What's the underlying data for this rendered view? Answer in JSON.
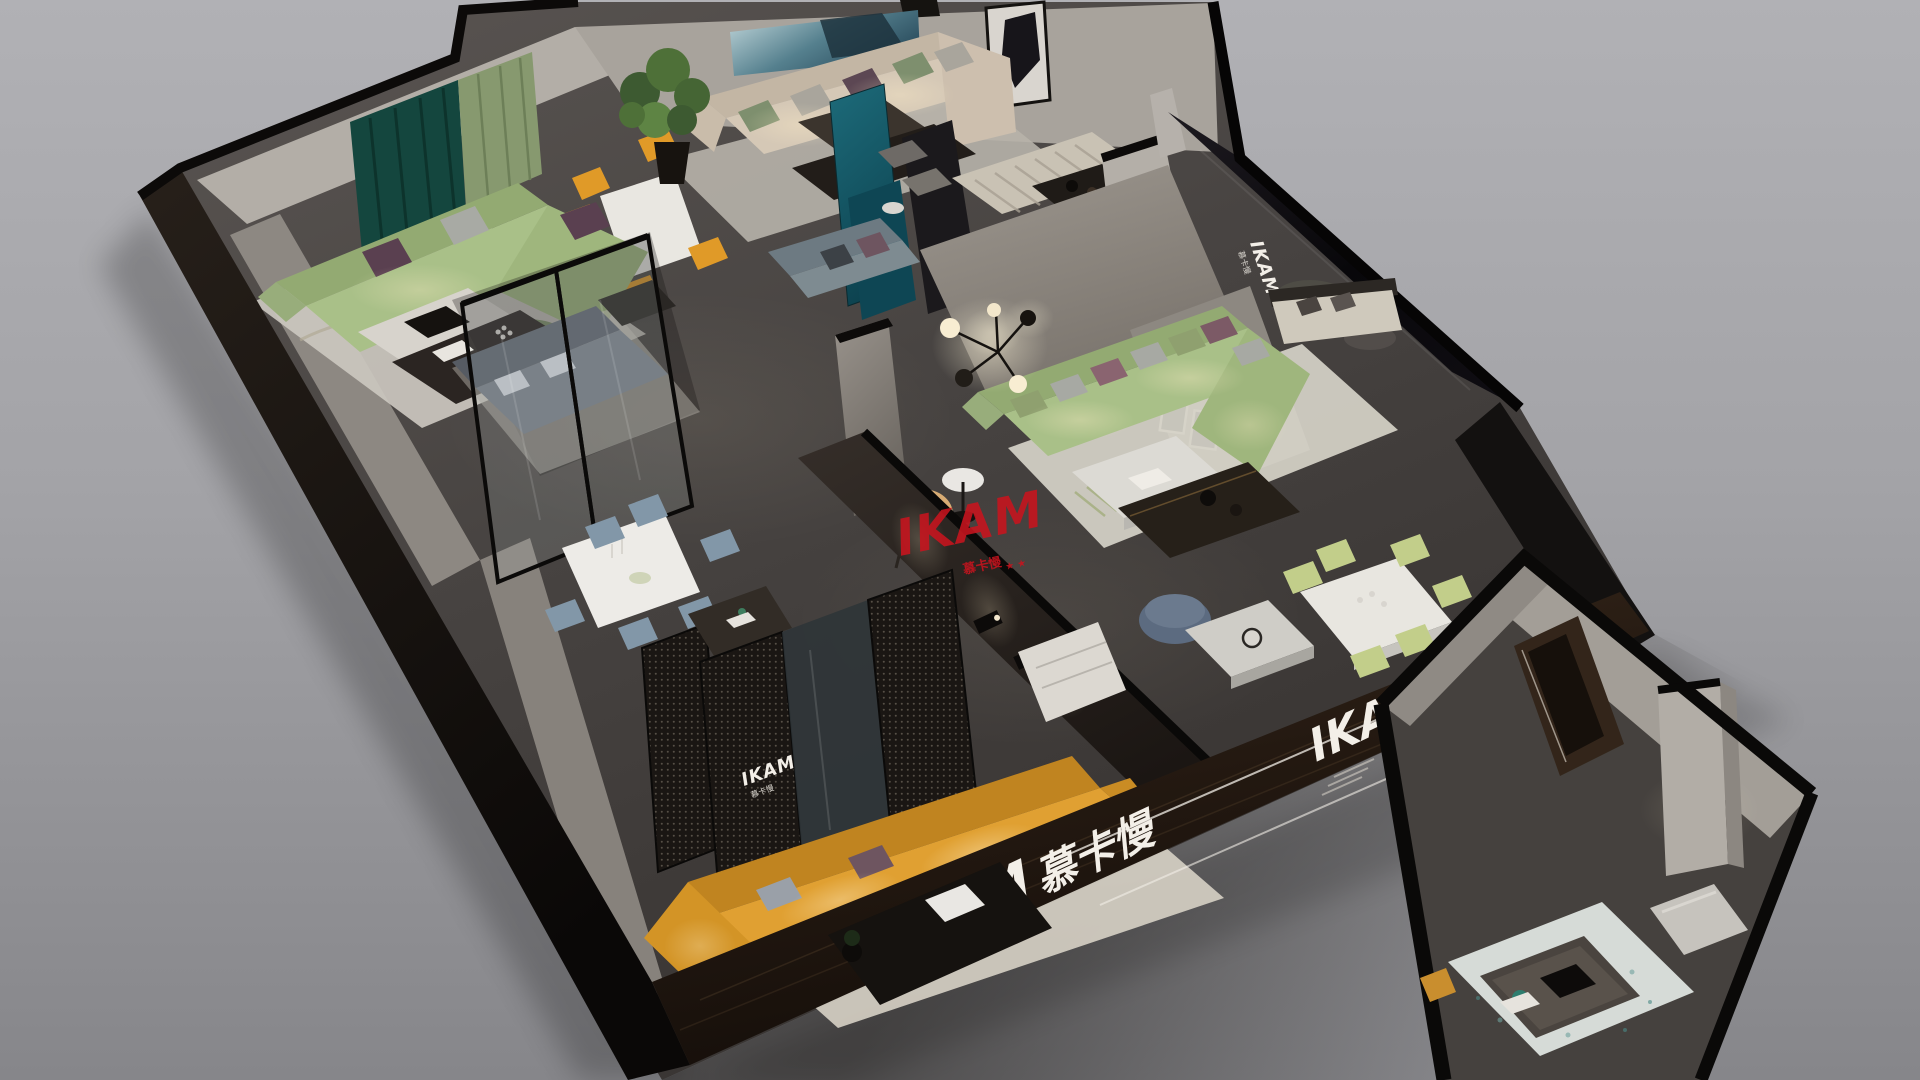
{
  "scene": {
    "type": "isometric-3d-render",
    "subject": "IKAM furniture showroom cutaway floor plan",
    "background": "#a8a8ac"
  },
  "branding": {
    "latin": "IKAM",
    "cjk": "慕卡慢",
    "stars": "★ ★",
    "logo_white": "#f3efe8",
    "watermark_red": "#c8141e"
  },
  "texts": {
    "glass_wall": {
      "latin": "IKAM",
      "cjk": "慕卡慢"
    },
    "screen": {
      "latin": "IKAM",
      "cjk": "慕卡慢"
    },
    "front_wall": {
      "latin": "IKAM",
      "cjk": "慕卡慢"
    },
    "right_wall": {
      "latin": "IKAM",
      "cjk": "慕卡慢"
    },
    "watermark": {
      "latin": "IKAM",
      "cjk": "慕卡慢",
      "stars": "★ ★"
    }
  },
  "palette": {
    "sofa_sage": "#a9c088",
    "sofa_sage_back": "#93aa72",
    "sofa_beige": "#d5c8b6",
    "sofa_orange": "#e0a032",
    "sofa_gray_blue": "#7e8b91",
    "armchair_tan": "#d8ac74",
    "chair_orange": "#e09a28",
    "chair_blue": "#8297a8",
    "chair_green": "#c2ce8a",
    "panel_teal": "#15606e",
    "curtain_teal": "#14463e",
    "curtain_sage": "#87996f",
    "pouf_blue": "#5c6b80",
    "floor_dark": "#4a4644",
    "wall_light": "#aaa49d",
    "wall_black": "#0d0b0a",
    "wood_dark": "#2e2219",
    "marble": "#dcdad4",
    "rug_cream": "#d6d2c8",
    "rug_teal_speckle": "#d6dbd7",
    "mural_blue": "#3a6878"
  }
}
